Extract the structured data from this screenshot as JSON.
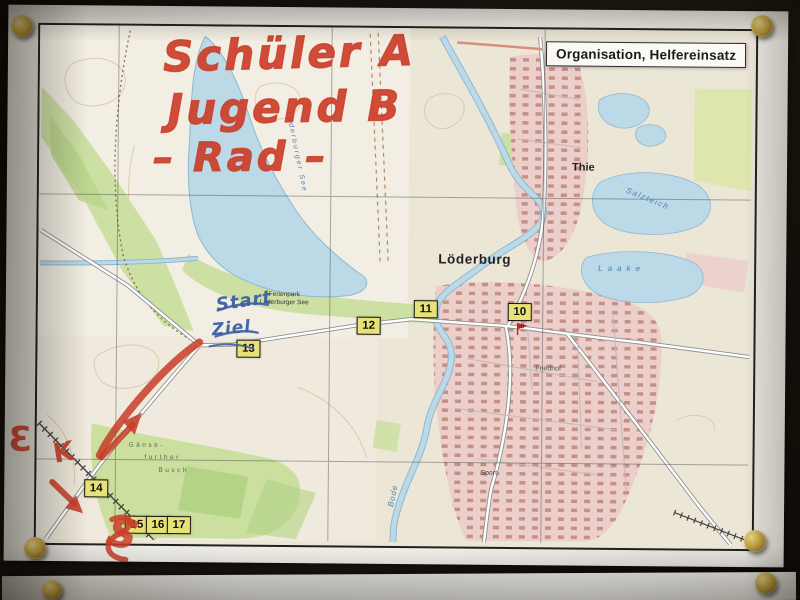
{
  "legend": {
    "label": "Organisation, Helfereinsatz"
  },
  "annotations": {
    "red": {
      "color": "#cb3e29",
      "line1": "Schüler A",
      "line2": "Jugend B",
      "line3": "– Rad –",
      "letter_left_margin": "Ɛ",
      "letter_k": "K",
      "letter_s_bottom": "S"
    },
    "blue": {
      "color": "#3b5fa4",
      "start": "Start",
      "finish": "Ziel"
    }
  },
  "map": {
    "colors": {
      "water": "#bcd9e8",
      "forest": "#cde0a4",
      "urban": "#eccfcb",
      "checkpoint_bg": "#e8e178",
      "contour": "#d8c7a3"
    },
    "checkpoints": [
      "10",
      "11",
      "12",
      "13",
      "14",
      "15",
      "16",
      "17"
    ],
    "labels": {
      "town": "Löderburg",
      "village": "Thie",
      "lake_vertical": "Löderburger See",
      "resort_line1": "Ferienpark",
      "resort_line2": "Löderburger See",
      "lake_salzteich": "Salzteich",
      "lake_laake": "Laake",
      "river": "Bode",
      "cemetery": "Friedhof",
      "sports": "Sport",
      "forest_line1": "Gänse-",
      "forest_line2": "further",
      "forest_line3": "Busch",
      "house_number": "8"
    }
  }
}
